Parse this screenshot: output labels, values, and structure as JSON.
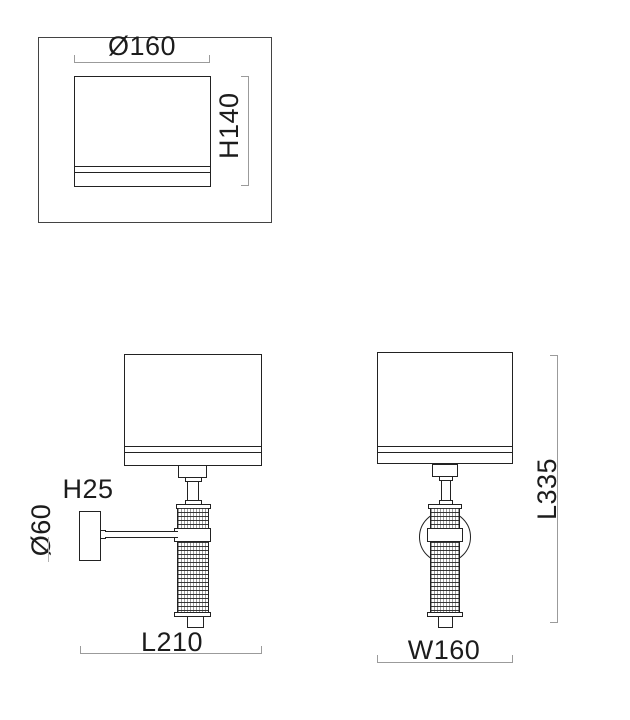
{
  "views": {
    "shade_detail": {
      "diameter_label": "Ø160",
      "height_label": "H140"
    },
    "side_view": {
      "arm_depth_label": "H25",
      "plate_diameter_label": "Ø60",
      "depth_label": "L210"
    },
    "front_view": {
      "total_height_label": "L335",
      "width_label": "W160"
    }
  },
  "colors": {
    "outline": "#222222",
    "dimension_line": "#9b9b9b",
    "label_text": "#1c1c1c",
    "background": "#ffffff"
  }
}
